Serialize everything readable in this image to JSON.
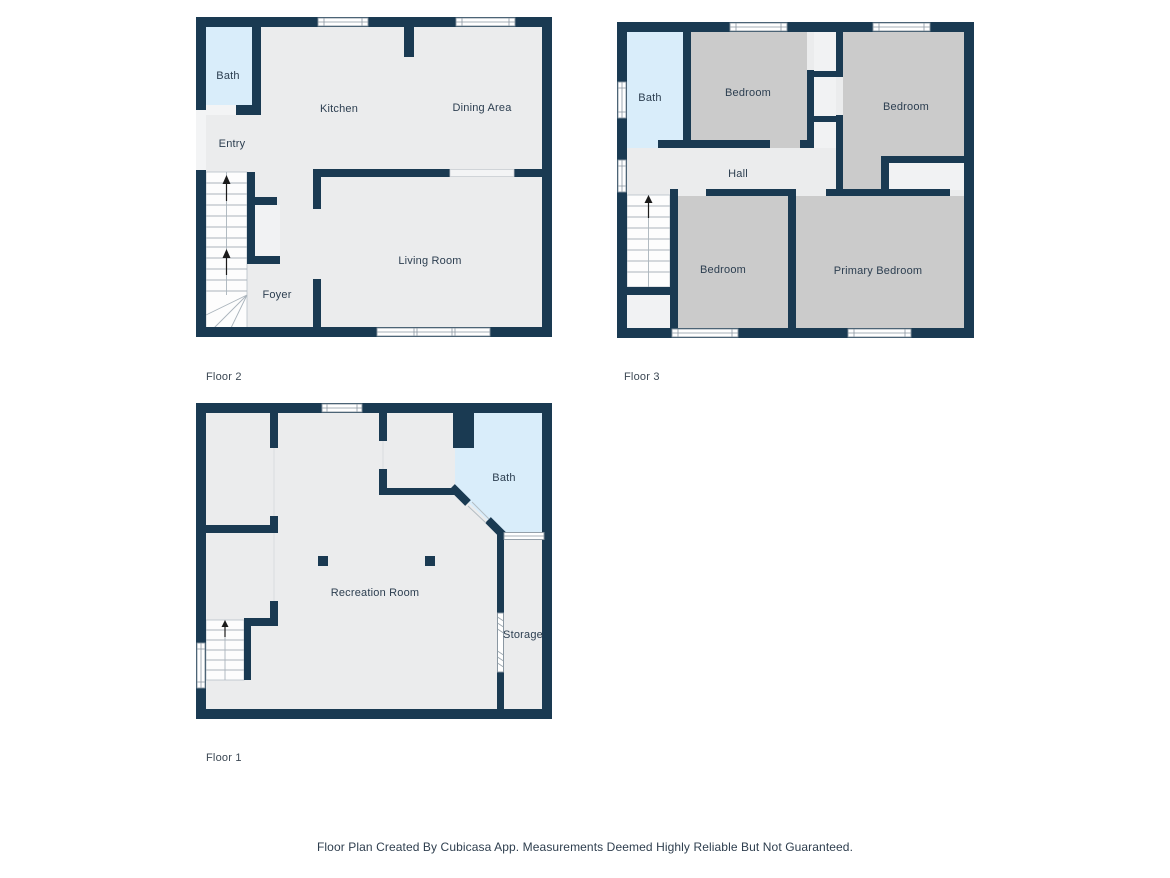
{
  "palette": {
    "wall": "#1a3a52",
    "room_floor": "#ebeced",
    "bedroom_floor": "#cbcbcb",
    "bath_floor": "#d9edfa",
    "label_text": "#2c3e50",
    "caption_text": "#3c4854",
    "footer_text": "#2e3e4e",
    "background": "#ffffff"
  },
  "floors": [
    {
      "caption": "Floor 2",
      "rooms": [
        {
          "label": "Bath"
        },
        {
          "label": "Kitchen"
        },
        {
          "label": "Dining Area"
        },
        {
          "label": "Entry"
        },
        {
          "label": "Living Room"
        },
        {
          "label": "Foyer"
        }
      ]
    },
    {
      "caption": "Floor 3",
      "rooms": [
        {
          "label": "Bath"
        },
        {
          "label": "Bedroom"
        },
        {
          "label": "Bedroom"
        },
        {
          "label": "Hall"
        },
        {
          "label": "Bedroom"
        },
        {
          "label": "Primary Bedroom"
        }
      ]
    },
    {
      "caption": "Floor 1",
      "rooms": [
        {
          "label": "Bath"
        },
        {
          "label": "Recreation Room"
        },
        {
          "label": "Storage"
        }
      ]
    }
  ],
  "footer": {
    "disclaimer": "Floor Plan Created By Cubicasa App. Measurements Deemed Highly Reliable But Not Guaranteed."
  }
}
